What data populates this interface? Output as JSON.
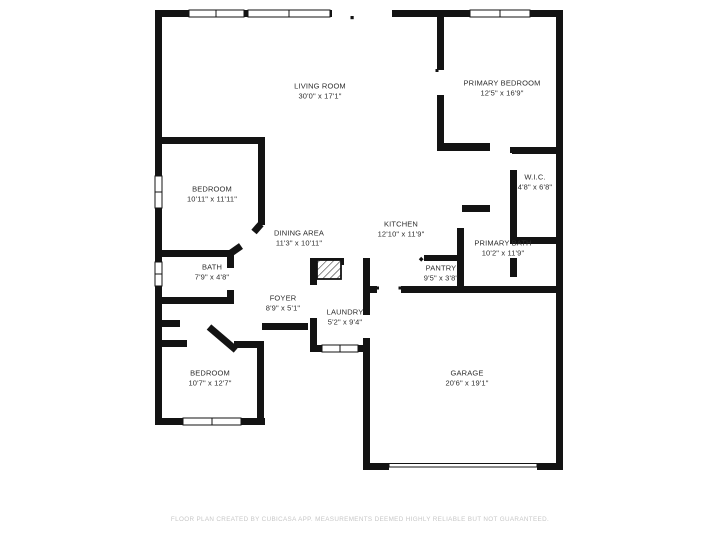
{
  "title": "Floor plan",
  "colors": {
    "wall": "#131313",
    "room_label": "#2d2d2d",
    "footer_text": "#c7c7c7",
    "background": "#ffffff",
    "window_fill": "#ffffff"
  },
  "rooms": [
    {
      "id": "living-room",
      "name": "LIVING ROOM",
      "dims": "30'0\" x 17'1\""
    },
    {
      "id": "primary-bedroom",
      "name": "PRIMARY BEDROOM",
      "dims": "12'5\" x 16'9\""
    },
    {
      "id": "bedroom-top",
      "name": "BEDROOM",
      "dims": "10'11\" x 11'11\""
    },
    {
      "id": "wic",
      "name": "W.I.C.",
      "dims": "4'8\" x 6'8\""
    },
    {
      "id": "dining-area",
      "name": "DINING AREA",
      "dims": "11'3\" x 10'11\""
    },
    {
      "id": "kitchen",
      "name": "KITCHEN",
      "dims": "12'10\" x 11'9\""
    },
    {
      "id": "primary-bath",
      "name": "PRIMARY BATH",
      "dims": "10'2\" x 11'9\""
    },
    {
      "id": "pantry",
      "name": "PANTRY",
      "dims": "9'5\" x 3'8\""
    },
    {
      "id": "bath",
      "name": "BATH",
      "dims": "7'9\" x 4'8\""
    },
    {
      "id": "foyer",
      "name": "FOYER",
      "dims": "8'9\" x 5'1\""
    },
    {
      "id": "laundry",
      "name": "LAUNDRY",
      "dims": "5'2\" x 9'4\""
    },
    {
      "id": "bedroom-bottom",
      "name": "BEDROOM",
      "dims": "10'7\" x 12'7\""
    },
    {
      "id": "garage",
      "name": "GARAGE",
      "dims": "20'6\" x 19'1\""
    }
  ],
  "footer": {
    "text": "FLOOR PLAN CREATED BY CUBICASA APP. MEASUREMENTS DEEMED HIGHLY RELIABLE BUT NOT GUARANTEED."
  }
}
